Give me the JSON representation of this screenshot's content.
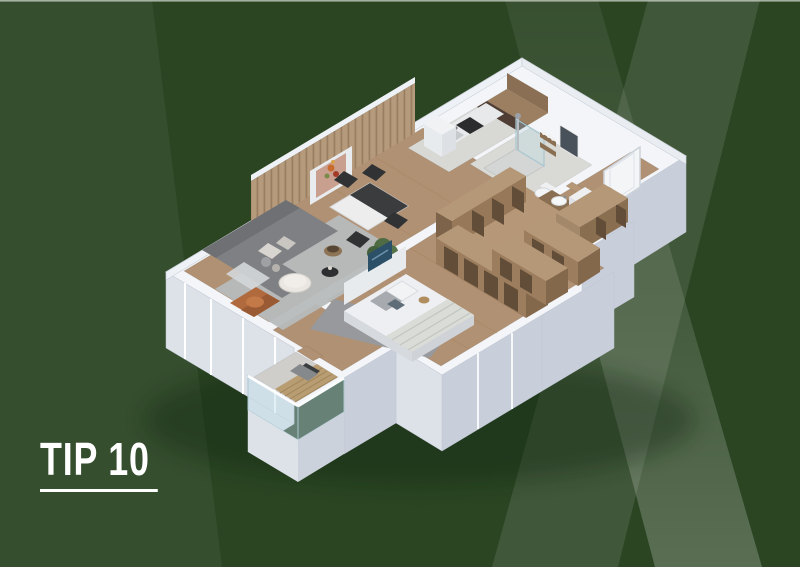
{
  "page": {
    "title": "TIP 10"
  },
  "label": {
    "text": "TIP 10"
  },
  "colors": {
    "bg_base": "#2b4523",
    "top_edge_line": "#ccd3c9",
    "walls": "#f3f5f8",
    "wall_face_light": "#dde2e9",
    "wall_face_dark": "#c9cfda",
    "wood_floor": "#b19173",
    "tile_floor": "#d8d8d4",
    "wardrobe_wood": "#b59878",
    "wardrobe_face": "#9c7e5e",
    "wardrobe_inset": "#624d39",
    "sofa": "#7e8084",
    "sofa_dark": "#6e7074",
    "rug": "#b7babc",
    "armchair": "#b06a3e",
    "counter_dark": "#503e34",
    "cabinet_wood": "#9c7f60",
    "bed_linen": "#edeff2",
    "plant": "#4e6b43",
    "balcony_deck": "#b99d72",
    "glass": "#bedce6",
    "art_blue": "#2c5068",
    "art_blush": "#c9a08f",
    "x_band_soft_effective": "#41603a",
    "x_band_bright_effective": "#5d7b52",
    "bg_left_wedge_effective": "#32502a"
  },
  "floorplan": {
    "type": "3d-isometric-apartment-cutaway",
    "unit_label": "TIP 10",
    "rooms": [
      {
        "id": "living-room",
        "furniture": [
          "corner-sofa",
          "back-cushions",
          "throw-blanket",
          "coffee-table",
          "black-side-table",
          "storage-basket",
          "area-rug",
          "leather-armchair",
          "floor-plant",
          "wood-slat-accent-wall",
          "wall-art-niche",
          "dining-table",
          "dining-chairs"
        ]
      },
      {
        "id": "kitchen",
        "furniture": [
          "l-shaped-counter",
          "wood-upper-cabinets",
          "dark-countertop",
          "cooktop",
          "sink",
          "tall-cabinet"
        ]
      },
      {
        "id": "bathroom",
        "furniture": [
          "walk-in-shower",
          "shower-column",
          "wall-shelves",
          "toiletry-bottles",
          "wall-hung-toilet",
          "vanity-sink",
          "mirror",
          "washing-machine"
        ]
      },
      {
        "id": "entry-hall",
        "furniture": [
          "front-door",
          "door-handle"
        ]
      },
      {
        "id": "hallway",
        "furniture": [
          "open-wardrobe-divider"
        ]
      },
      {
        "id": "storage-closets",
        "furniture": [
          "open-shelving-row-upper",
          "open-shelving-row-mid",
          "open-shelving-row-lower"
        ]
      },
      {
        "id": "bedroom",
        "furniture": [
          "double-bed",
          "headboard",
          "pillows",
          "striped-foot-throw",
          "blue-wall-art",
          "bedside-stool",
          "area-rug",
          "wardrobe-row",
          "window-wall"
        ]
      },
      {
        "id": "balcony",
        "furniture": [
          "wood-deck",
          "lounge-chair",
          "glass-railing",
          "railing-top-rail"
        ]
      }
    ]
  }
}
